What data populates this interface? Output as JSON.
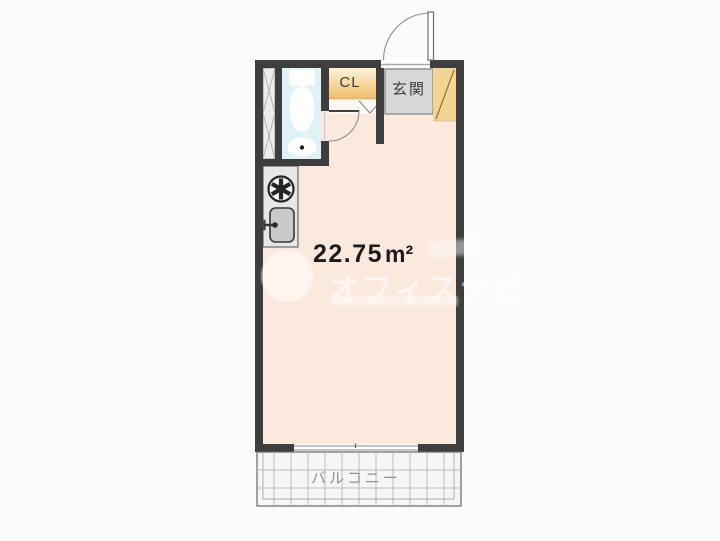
{
  "palette": {
    "bg": "#fbfbfb",
    "wall": "#3e3e3e",
    "room": "#fce9dd",
    "bath": "#dff3f7",
    "nook": "#fdf8f4",
    "pipe_space": "#ececec",
    "closet_top": "#fdf3da",
    "closet_bottom": "#efbd67",
    "shoe": "#f4d493",
    "genkan": "#d7d7d7",
    "genkan_border": "#8f8f8f",
    "kitchen": "#e7e7e7",
    "balcony": "#f6f6f6",
    "grid_line": "#bcbcbc",
    "text_dark": "#1c1c1c",
    "label_gray": "#3c3c3c",
    "balcony_text": "#919191",
    "watermark": "rgba(255,255,255,0.55)",
    "watermark_soft": "rgba(255,255,255,0.45)"
  },
  "rooms": {
    "main": {
      "area_value": "22.75",
      "area_unit": "m²"
    },
    "closet": {
      "label": "CL"
    },
    "entrance": {
      "label": "玄関"
    },
    "balcony": {
      "label": "バルコニー"
    }
  },
  "watermark": {
    "text": "オフィスナビ"
  },
  "fixtures": [
    "entrance-door-icon",
    "bathroom-door-icon",
    "folding-door-icon",
    "toilet-icon",
    "washbasin-icon",
    "stove-burner-icon",
    "kitchen-sink-icon",
    "pipe-shaft-icon",
    "sliding-window-icon",
    "shoe-cabinet-icon"
  ]
}
